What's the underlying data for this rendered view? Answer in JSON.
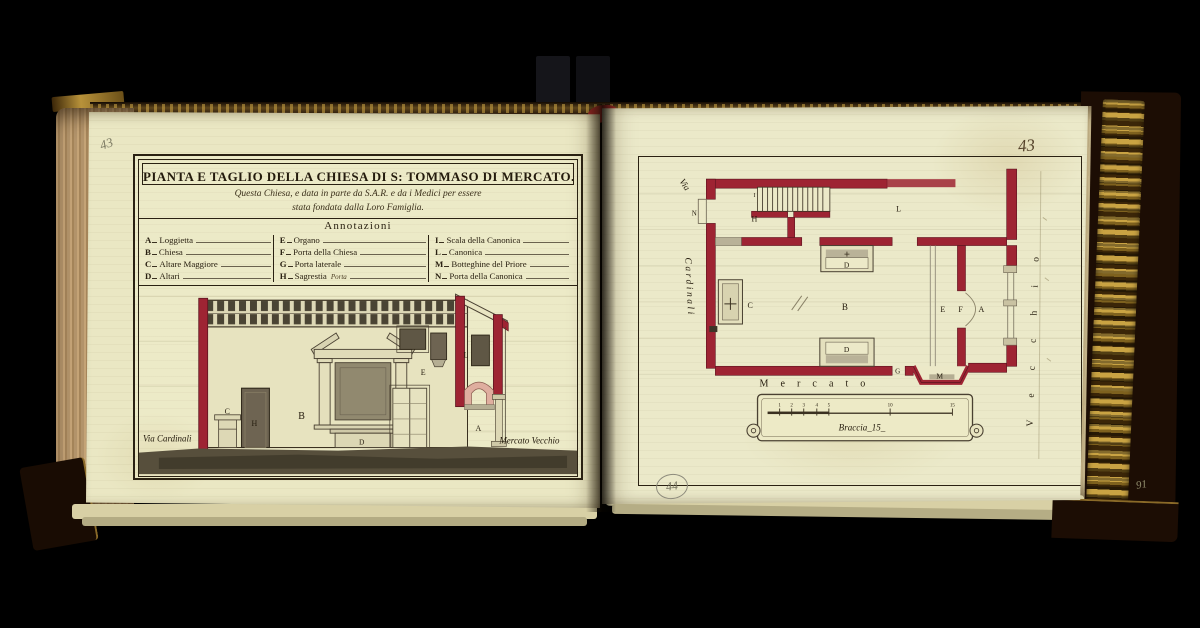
{
  "left_page": {
    "pencil_number": "43",
    "title": "PIANTA E TAGLIO DELLA CHIESA DI S: TOMMASO DI MERCATO.",
    "subtitle": [
      "Questa Chiesa, e data in parte da S.A.R. e da i Medici per essere",
      "stata fondata dalla Loro Famiglia."
    ],
    "annotations_title": "Annotazioni",
    "legend": {
      "col1": [
        {
          "k": "A",
          "v": "Loggietta"
        },
        {
          "k": "B",
          "v": "Chiesa"
        },
        {
          "k": "C",
          "v": "Altare Maggiore"
        },
        {
          "k": "D",
          "v": "Altari"
        }
      ],
      "col2": [
        {
          "k": "E",
          "v": "Organo"
        },
        {
          "k": "F",
          "v": "Porta della Chiesa"
        },
        {
          "k": "G",
          "v": "Porta laterale"
        },
        {
          "k": "H",
          "v": "Sagrestia",
          "note": "Porta"
        }
      ],
      "col3": [
        {
          "k": "I",
          "v": "Scala della Canonica"
        },
        {
          "k": "L",
          "v": "Canonica"
        },
        {
          "k": "M",
          "v": "Botteghine del Priore"
        },
        {
          "k": "N",
          "v": "Porta della Canonica"
        }
      ]
    },
    "section": {
      "labels": {
        "C": "C",
        "H": "H",
        "B": "B",
        "D": "D",
        "E": "E",
        "L": "L",
        "A": "A"
      },
      "street_left": "Via Cardinali",
      "street_right": "Mercato Vecchio"
    }
  },
  "right_page": {
    "ink_page_number": "43",
    "stamp_number": "44",
    "pencil_edge_number": "91",
    "plan": {
      "labels": {
        "N": "N",
        "I": "I",
        "H": "H",
        "L": "L",
        "C": "C",
        "B": "B",
        "D_upper": "D",
        "D_lower": "D",
        "E": "E",
        "F": "F",
        "A": "A",
        "G": "G",
        "M": "M"
      },
      "street_top": "Via",
      "street_left": "Cardinali",
      "street_bottom": "Mercato",
      "street_right": "Vecchio",
      "scale_label": "Braccia_15_",
      "scale_ticks": [
        "1",
        "2",
        "3",
        "4",
        "5",
        "10",
        "15"
      ]
    }
  },
  "colors": {
    "wall_red": "#9e2433",
    "page_cream": "#eae7c3",
    "ink": "#2a2112",
    "pink_wash": "#dfae9f",
    "gold": "#c9a343"
  }
}
